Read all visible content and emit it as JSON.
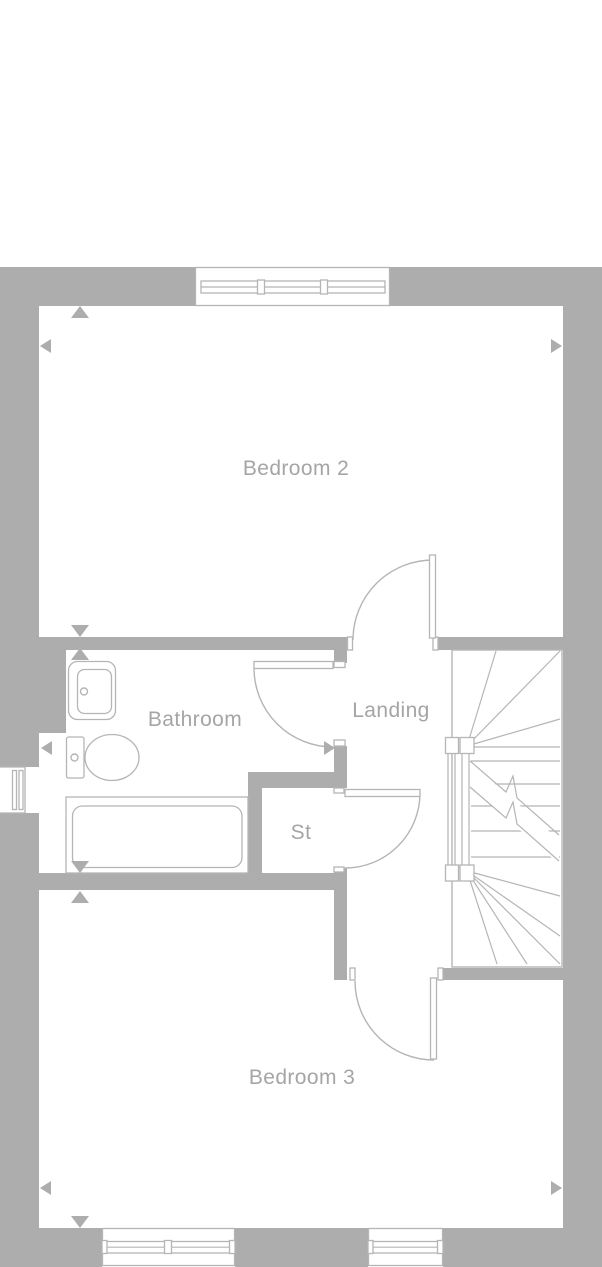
{
  "floorplan": {
    "rooms": [
      {
        "id": "bedroom-2",
        "label": "Bedroom 2"
      },
      {
        "id": "bathroom",
        "label": "Bathroom"
      },
      {
        "id": "landing",
        "label": "Landing"
      },
      {
        "id": "storage",
        "label": "St"
      },
      {
        "id": "bedroom-3",
        "label": "Bedroom 3"
      }
    ],
    "colors": {
      "wall": "#adadad",
      "line": "#b5b5b5",
      "text": "#a5a5a5",
      "bg": "#ffffff"
    }
  }
}
